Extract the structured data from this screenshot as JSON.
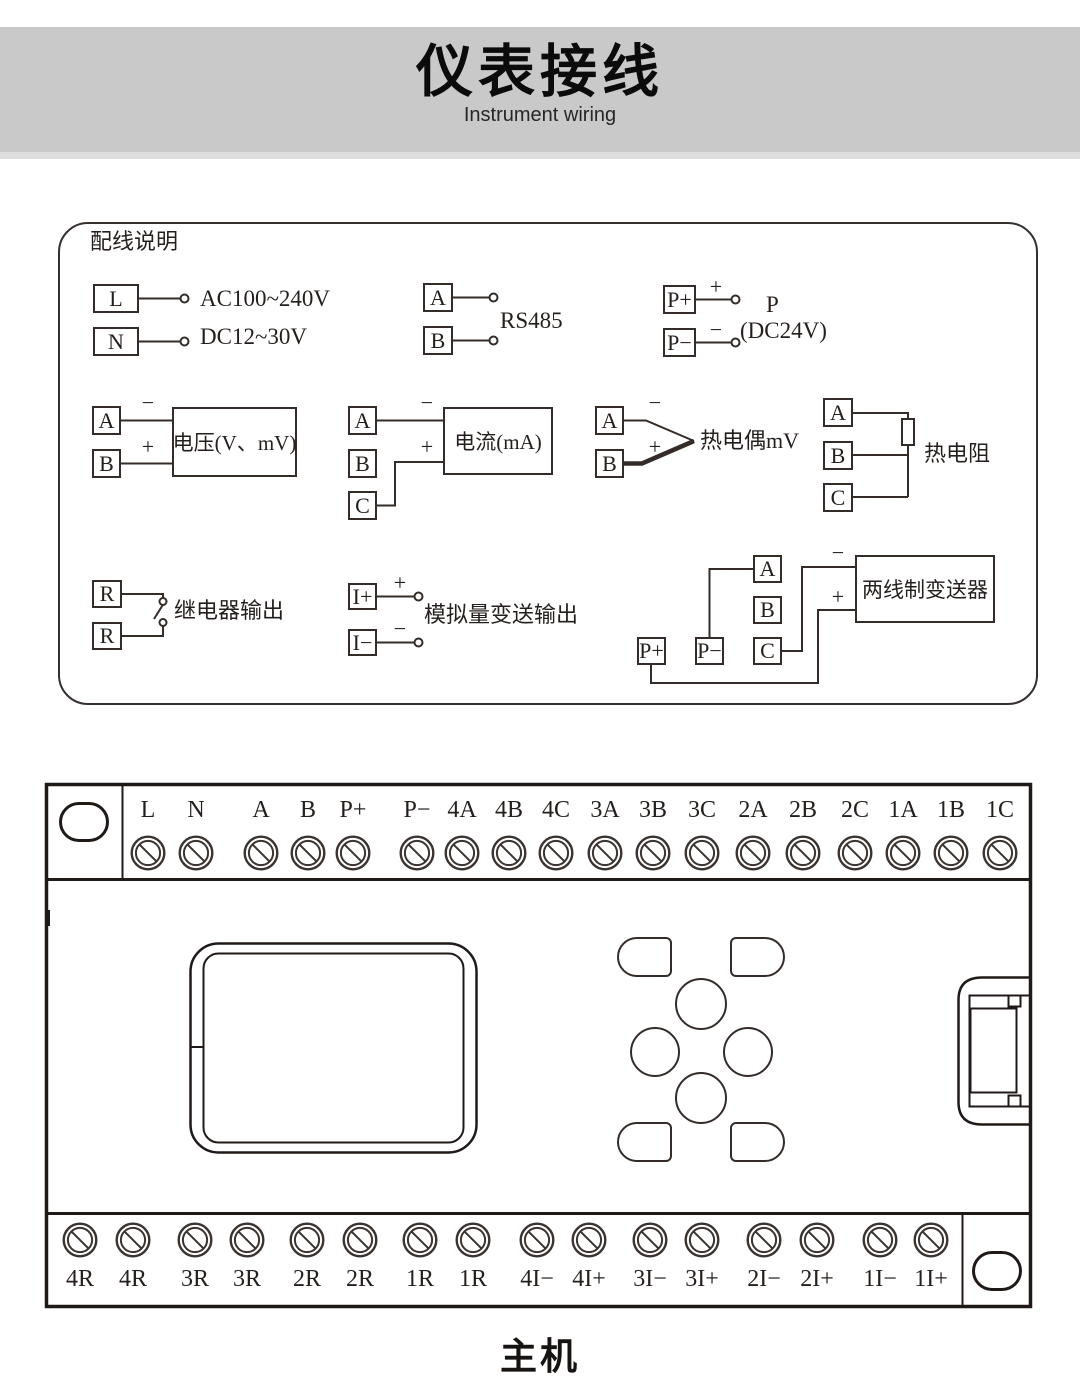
{
  "header": {
    "title": "仪表接线",
    "subtitle": "Instrument wiring"
  },
  "signs": {
    "plus": "+",
    "minus": "−"
  },
  "wiring_panel": {
    "title": "配线说明",
    "power_supply": {
      "t1": "L",
      "t2": "N",
      "line1": "AC100~240V",
      "line2": "DC12~30V"
    },
    "rs485": {
      "t1": "A",
      "t2": "B",
      "label": "RS485"
    },
    "power_24v": {
      "t1": "P+",
      "t2": "P−",
      "label1": "P",
      "label2": "(DC24V)"
    },
    "voltage": {
      "t1": "A",
      "t2": "B",
      "label": "电压(V、mV)"
    },
    "current": {
      "t1": "A",
      "t2": "B",
      "t3": "C",
      "label": "电流(mA)"
    },
    "thermocouple": {
      "t1": "A",
      "t2": "B",
      "label": "热电偶mV"
    },
    "rtd": {
      "t1": "A",
      "t2": "B",
      "t3": "C",
      "label": "热电阻"
    },
    "relay": {
      "t1": "R",
      "t2": "R",
      "label": "继电器输出"
    },
    "analog_out": {
      "t1": "I+",
      "t2": "I−",
      "label": "模拟量变送输出"
    },
    "transmitter": {
      "ta": "A",
      "tb": "B",
      "tc": "C",
      "tp": "P+",
      "tm": "P−",
      "label": "两线制变送器"
    }
  },
  "terminal_block": {
    "top_labels": [
      "L",
      "N",
      "A",
      "B",
      "P+",
      "P−",
      "4A",
      "4B",
      "4C",
      "3A",
      "3B",
      "3C",
      "2A",
      "2B",
      "2C",
      "1A",
      "1B",
      "1C"
    ],
    "bottom_labels": [
      "4R",
      "4R",
      "3R",
      "3R",
      "2R",
      "2R",
      "1R",
      "1R",
      "4I−",
      "4I+",
      "3I−",
      "3I+",
      "2I−",
      "2I+",
      "1I−",
      "1I+"
    ],
    "caption": "主机"
  }
}
